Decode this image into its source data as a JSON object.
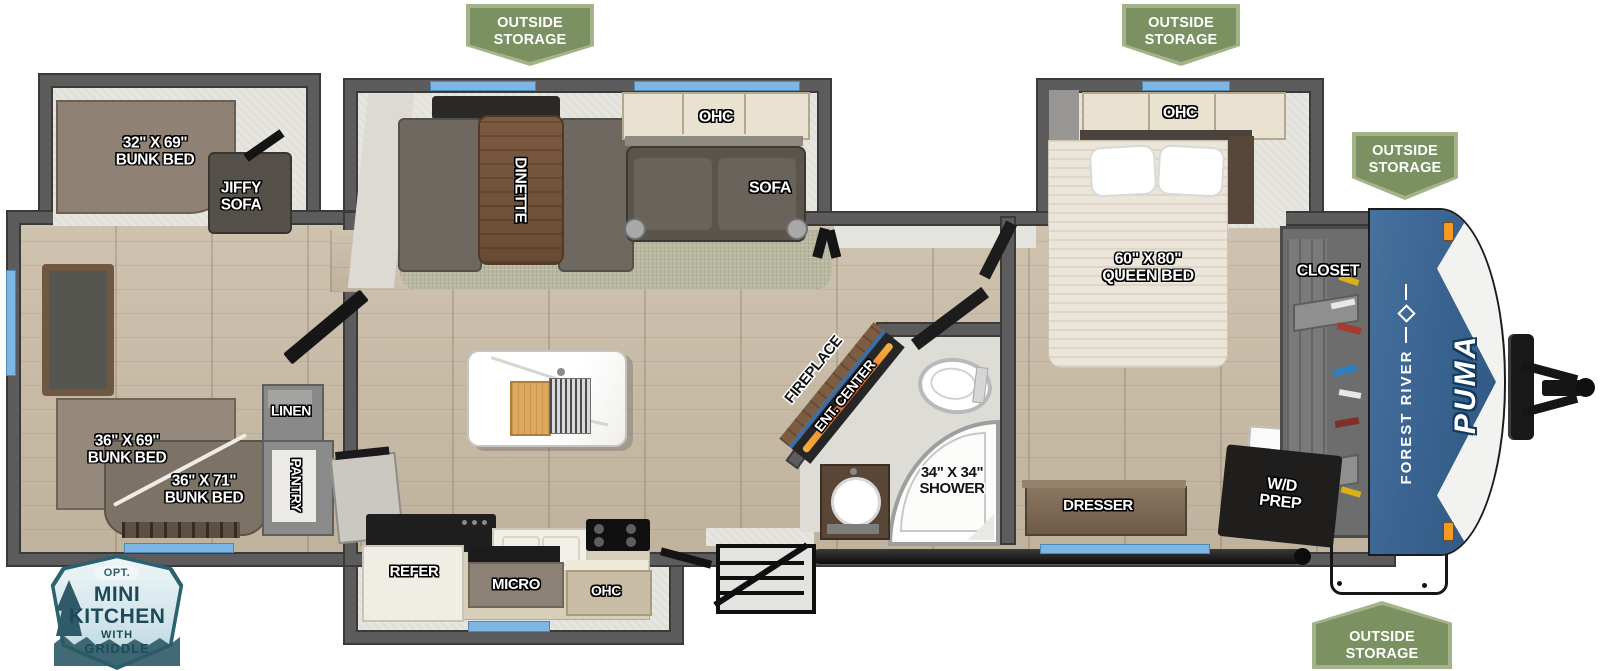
{
  "badges": {
    "outside_storage_label": "OUTSIDE\nSTORAGE",
    "mini_kitchen": {
      "opt": "OPT.",
      "title1": "MINI",
      "title2": "KITCHEN",
      "sub1": "WITH",
      "sub2": "GRIDDLE"
    }
  },
  "branding": {
    "make": "FOREST RIVER",
    "model": "PUMA"
  },
  "rooms": {
    "rear_bunk_slide": {
      "bunk": "32\" X 69\"\nBUNK BED",
      "jiffy_sofa": "JIFFY\nSOFA"
    },
    "rear_room": {
      "bunk_upper": "36\" X 69\"\nBUNK BED",
      "bunk_lower": "36\" X 71\"\nBUNK BED",
      "linen": "LINEN",
      "pantry": "PANTRY"
    },
    "living": {
      "dinette": "DINETTE",
      "ohc": "OHC",
      "sofa": "SOFA",
      "fireplace": "FIREPLACE",
      "ent_center": "ENT. CENTER"
    },
    "kitchen": {
      "refer": "REFER",
      "micro": "MICRO",
      "ohc": "OHC"
    },
    "bath": {
      "shower": "34\" X 34\"\nSHOWER"
    },
    "bedroom": {
      "ohc": "OHC",
      "bed": "60\" X 80\"\nQUEEN BED",
      "closet": "CLOSET",
      "dresser": "DRESSER",
      "wd_prep": "W/D\nPREP"
    }
  },
  "colors": {
    "badge_green": "#7b9161",
    "window_accent_blue": "#7db5e4",
    "front_cap_blue": "#3a6391",
    "wall_gray": "#5c5c5c",
    "floor_tan": "#c9bca6"
  }
}
